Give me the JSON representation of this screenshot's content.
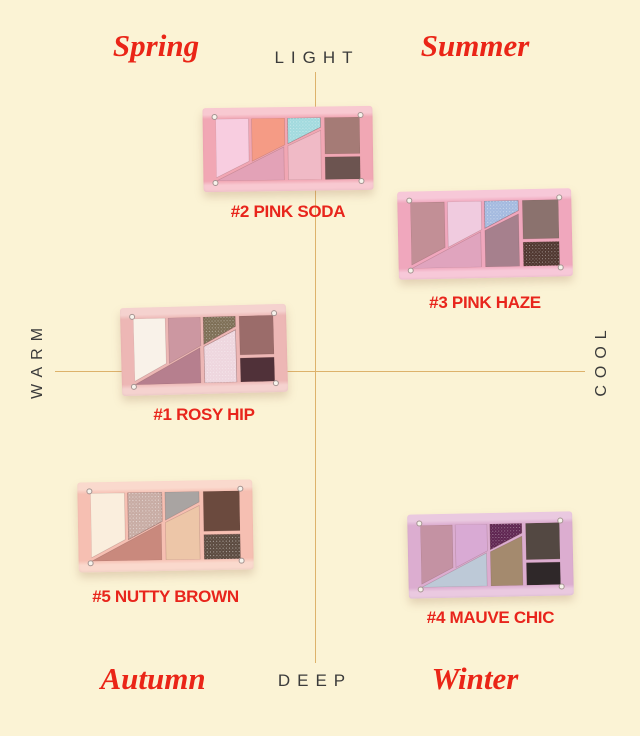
{
  "axes": {
    "top": "LIGHT",
    "bottom": "DEEP",
    "left": "WARM",
    "right": "COOL"
  },
  "quadrants": {
    "top_left": "Spring",
    "top_right": "Summer",
    "bottom_left": "Autumn",
    "bottom_right": "Winter"
  },
  "colors": {
    "background": "#fbf3d5",
    "axis_line": "#ddb26b",
    "axis_text": "#3b3b3b",
    "season_text": "#ea2517",
    "label_text": "#e8251c"
  },
  "palettes": [
    {
      "label": "#2 PINK SODA",
      "frame": "#f1a7b4",
      "frame_light": "#f8c9d1",
      "swatches": {
        "pane1": "#f8cde0",
        "pane2": "#f59b85",
        "pane3": "#a2dade",
        "band": "#e3a2b7",
        "pane4": "#f0bac6",
        "right_top": "#a57b76",
        "right_bottom": "#6c5450"
      },
      "sparkle": [
        "pane3"
      ]
    },
    {
      "label": "#3 PINK HAZE",
      "frame": "#f0a7bd",
      "frame_light": "#f7c8d8",
      "swatches": {
        "pane1": "#c28f96",
        "pane2": "#f0cbdf",
        "pane3": "#a4badf",
        "band": "#e0a4be",
        "pane4": "#a6808d",
        "right_top": "#8b726e",
        "right_bottom": "#503730"
      },
      "sparkle": [
        "pane3",
        "right_bottom"
      ]
    },
    {
      "label": "#1 ROSY HIP",
      "frame": "#edb7b5",
      "frame_light": "#f5d2cf",
      "swatches": {
        "pane1": "#f9f2e9",
        "pane2": "#cc97a1",
        "pane3": "#7e6f56",
        "band": "#b67f8e",
        "pane4": "#eed6de",
        "right_top": "#9b6c6a",
        "right_bottom": "#503139"
      },
      "sparkle": [
        "pane3",
        "pane4"
      ]
    },
    {
      "label": "#5 NUTTY BROWN",
      "frame": "#f6bfb2",
      "frame_light": "#fad9cd",
      "swatches": {
        "pane1": "#faeedd",
        "pane2": "#c8aca4",
        "pane3": "#a9a4a2",
        "band": "#c9897d",
        "pane4": "#edc6a8",
        "right_top": "#6b4a3e",
        "right_bottom": "#5c4b40"
      },
      "sparkle": [
        "pane2",
        "right_bottom"
      ]
    },
    {
      "label": "#4 MAUVE CHIC",
      "frame": "#dcadd0",
      "frame_light": "#eac9e0",
      "swatches": {
        "pane1": "#c492a3",
        "pane2": "#d9aad4",
        "pane3": "#5f2551",
        "band": "#bdc9d7",
        "pane4": "#a48a6e",
        "right_top": "#534842",
        "right_bottom": "#2f2829"
      },
      "sparkle": [
        "pane3"
      ]
    }
  ]
}
